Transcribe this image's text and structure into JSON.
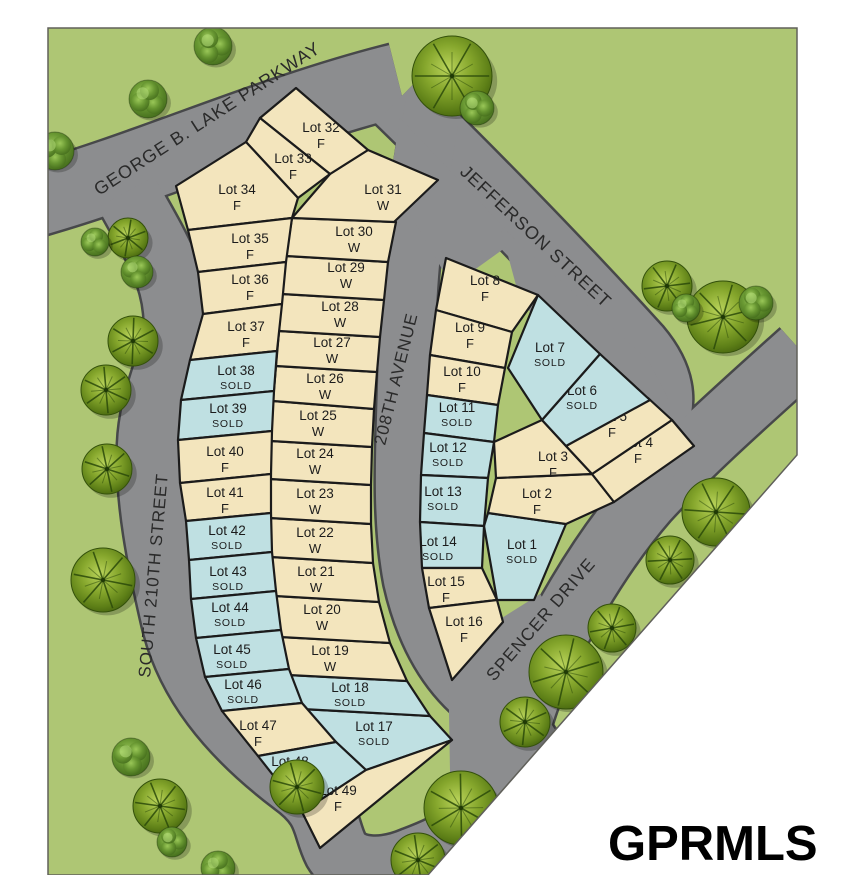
{
  "logo": {
    "text": "GPRMLS"
  },
  "colors": {
    "page": "#ffffff",
    "grass": "#aec674",
    "road": "#8c8d8f",
    "road_edge": "#47484a",
    "lot_available": "#f3e5bd",
    "lot_sold": "#bfe0e2",
    "lot_border": "#1b1b1b",
    "text": "#2a2a2a"
  },
  "map": {
    "outline": "48,28 797,28 797,455 428,875 48,875"
  },
  "streets": [
    {
      "name": "george-b-lake-parkway",
      "label": "GEORGE B. LAKE PARKWAY",
      "x": 99,
      "y": 196,
      "rotate": -33,
      "size": 18
    },
    {
      "name": "jefferson-street",
      "label": "JEFFERSON STREET",
      "x": 459,
      "y": 173,
      "rotate": 43,
      "size": 18
    },
    {
      "name": "208th-avenue",
      "label": "208TH AVENUE",
      "x": 385,
      "y": 446,
      "rotate": -76,
      "size": 17
    },
    {
      "name": "south-210th-street",
      "label": "SOUTH 210TH STREET",
      "x": 150,
      "y": 678,
      "rotate": -85,
      "size": 17
    },
    {
      "name": "spencer-drive",
      "label": "SPENCER DRIVE",
      "x": 494,
      "y": 682,
      "rotate": -49,
      "size": 17.5
    }
  ],
  "roads": [
    {
      "name": "george-b-lake-parkway",
      "d": "M 28,202 C 150,168 270,112 398,80",
      "w": 72
    },
    {
      "name": "jefferson-street",
      "d": "M 398,100 C 468,168 560,262 638,348 C 665,380 667,410 646,438",
      "w": 64
    },
    {
      "name": "spencer-drive",
      "d": "M 802,352 C 742,406 690,452 646,500 C 600,553 552,634 528,698 C 516,732 509,762 508,790",
      "w": 62
    },
    {
      "name": "south-210th-street",
      "d": "M 126,192 C 152,240 172,268 176,310 C 181,352 152,390 150,445 C 148,500 160,560 174,620 C 188,680 228,732 294,782 C 330,808 324,826 336,850 C 350,874 386,872 414,860 C 452,846 492,824 510,790",
      "w": 64
    },
    {
      "name": "208th-avenue",
      "d": "M 434,100 C 420,180 408,260 407,340 C 406,430 398,508 412,580 C 426,642 454,686 498,712 C 520,726 536,746 540,766",
      "w": 56
    },
    {
      "name": "junction-jefferson-avenue",
      "d": "M 400,118 L 516,240 L 452,286 L 390,180 Z",
      "fill": true
    },
    {
      "name": "junction-jefferson-flank",
      "d": "M 500,226 L 648,360 L 668,398 L 636,434 L 520,300 Z",
      "fill": true
    },
    {
      "name": "junction-spencer-elbow",
      "d": "M 628,392 L 700,436 L 656,504 L 602,450 Z",
      "fill": true
    },
    {
      "name": "junction-south",
      "d": "M 448,652 L 540,594 L 578,648 L 540,744 L 522,800 L 450,772 Z",
      "fill": true
    }
  ],
  "lots": [
    {
      "name": "Lot 1",
      "status": "SOLD",
      "pts": "488,513 566,524 534,600 497,600 484,526",
      "lx": 522,
      "ly": 549
    },
    {
      "name": "Lot 2",
      "status": "F",
      "pts": "496,478 592,474 614,502 566,524 488,513",
      "lx": 537,
      "ly": 498
    },
    {
      "name": "Lot 3",
      "status": "F",
      "pts": "494,442 542,420 566,446 592,474 496,478",
      "lx": 553,
      "ly": 461
    },
    {
      "name": "Lot 4",
      "status": "F",
      "pts": "672,420 694,446 614,502 592,474",
      "lx": 638,
      "ly": 447
    },
    {
      "name": "Lot 5",
      "status": "F",
      "pts": "648,398 672,420 592,474 566,446",
      "lx": 612,
      "ly": 421
    },
    {
      "name": "Lot 6",
      "status": "SOLD",
      "pts": "600,354 650,400 566,446 542,420",
      "lx": 582,
      "ly": 395
    },
    {
      "name": "Lot 7",
      "status": "SOLD",
      "pts": "538,295 600,354 542,420 508,368",
      "lx": 550,
      "ly": 352
    },
    {
      "name": "Lot 8",
      "status": "F",
      "pts": "446,258 538,295 512,332 436,310",
      "lx": 485,
      "ly": 285
    },
    {
      "name": "Lot 9",
      "status": "F",
      "pts": "436,310 512,332 505,368 430,355",
      "lx": 470,
      "ly": 332
    },
    {
      "name": "Lot 10",
      "status": "F",
      "pts": "430,355 505,368 498,405 427,395",
      "lx": 462,
      "ly": 376
    },
    {
      "name": "Lot 11",
      "status": "SOLD",
      "pts": "427,395 498,405 494,442 424,433",
      "lx": 457,
      "ly": 412
    },
    {
      "name": "Lot 12",
      "status": "SOLD",
      "pts": "424,433 494,442 488,478 421,475",
      "lx": 448,
      "ly": 452
    },
    {
      "name": "Lot 13",
      "status": "SOLD",
      "pts": "421,475 488,478 484,526 420,522",
      "lx": 443,
      "ly": 496
    },
    {
      "name": "Lot 14",
      "status": "SOLD",
      "pts": "420,522 484,526 482,568 422,568",
      "lx": 438,
      "ly": 546
    },
    {
      "name": "Lot 15",
      "status": "F",
      "pts": "422,568 482,568 497,600 429,608",
      "lx": 446,
      "ly": 586
    },
    {
      "name": "Lot 16",
      "status": "F",
      "pts": "429,608 497,600 503,622 452,680",
      "lx": 464,
      "ly": 626
    },
    {
      "name": "Lot 17",
      "status": "SOLD",
      "pts": "302,709 430,716 452,740 366,770 336,742",
      "lx": 374,
      "ly": 731
    },
    {
      "name": "Lot 18",
      "status": "SOLD",
      "pts": "288,675 407,681 430,716 302,709",
      "lx": 350,
      "ly": 692
    },
    {
      "name": "Lot 19",
      "status": "W",
      "pts": "280,637 390,643 407,681 288,675",
      "lx": 330,
      "ly": 655
    },
    {
      "name": "Lot 20",
      "status": "W",
      "pts": "275,596 379,602 390,643 280,637",
      "lx": 322,
      "ly": 614
    },
    {
      "name": "Lot 21",
      "status": "W",
      "pts": "271,557 373,563 379,602 275,596",
      "lx": 316,
      "ly": 576
    },
    {
      "name": "Lot 22",
      "status": "W",
      "pts": "270,518 371,524 373,563 271,557",
      "lx": 315,
      "ly": 537
    },
    {
      "name": "Lot 23",
      "status": "W",
      "pts": "270,479 371,485 371,524 270,518",
      "lx": 315,
      "ly": 498
    },
    {
      "name": "Lot 24",
      "status": "W",
      "pts": "271,441 372,447 371,485 270,479",
      "lx": 315,
      "ly": 458
    },
    {
      "name": "Lot 25",
      "status": "W",
      "pts": "273,401 374,409 372,447 271,441",
      "lx": 318,
      "ly": 420
    },
    {
      "name": "Lot 26",
      "status": "W",
      "pts": "276,366 377,372 374,409 273,401",
      "lx": 325,
      "ly": 383
    },
    {
      "name": "Lot 27",
      "status": "W",
      "pts": "279,331 380,337 377,372 276,366",
      "lx": 332,
      "ly": 347
    },
    {
      "name": "Lot 28",
      "status": "W",
      "pts": "282,294 384,300 380,337 279,331",
      "lx": 340,
      "ly": 311
    },
    {
      "name": "Lot 29",
      "status": "W",
      "pts": "286,256 388,262 384,300 282,294",
      "lx": 346,
      "ly": 272
    },
    {
      "name": "Lot 30",
      "status": "W",
      "pts": "292,218 396,222 388,262 286,256",
      "lx": 354,
      "ly": 236
    },
    {
      "name": "Lot 31",
      "status": "W",
      "pts": "368,150 438,180 394,222 292,218 330,174",
      "lx": 383,
      "ly": 194
    },
    {
      "name": "Lot 32",
      "status": "F",
      "pts": "296,88 368,150 330,174 260,118",
      "lx": 321,
      "ly": 132
    },
    {
      "name": "Lot 33",
      "status": "F",
      "pts": "260,118 330,174 298,198 246,142",
      "lx": 293,
      "ly": 163
    },
    {
      "name": "Lot 34",
      "status": "F",
      "pts": "246,142 298,198 292,218 188,230 176,186",
      "lx": 237,
      "ly": 194
    },
    {
      "name": "Lot 35",
      "status": "F",
      "pts": "188,230 292,218 286,262 198,272",
      "lx": 250,
      "ly": 243
    },
    {
      "name": "Lot 36",
      "status": "F",
      "pts": "198,272 286,262 282,304 203,314",
      "lx": 250,
      "ly": 284
    },
    {
      "name": "Lot 37",
      "status": "F",
      "pts": "203,314 282,304 277,351 190,360",
      "lx": 246,
      "ly": 331
    },
    {
      "name": "Lot 38",
      "status": "SOLD",
      "pts": "190,360 277,351 274,391 181,400",
      "lx": 236,
      "ly": 375
    },
    {
      "name": "Lot 39",
      "status": "SOLD",
      "pts": "181,400 274,391 272,431 178,440",
      "lx": 228,
      "ly": 413
    },
    {
      "name": "Lot 40",
      "status": "F",
      "pts": "178,440 272,431 271,474 180,483",
      "lx": 225,
      "ly": 456
    },
    {
      "name": "Lot 41",
      "status": "F",
      "pts": "180,483 271,474 271,513 186,521",
      "lx": 225,
      "ly": 497
    },
    {
      "name": "Lot 42",
      "status": "SOLD",
      "pts": "186,521 271,513 272,552 189,560",
      "lx": 227,
      "ly": 535
    },
    {
      "name": "Lot 43",
      "status": "SOLD",
      "pts": "189,560 272,552 276,591 191,599",
      "lx": 228,
      "ly": 576
    },
    {
      "name": "Lot 44",
      "status": "SOLD",
      "pts": "191,599 276,591 281,630 196,638",
      "lx": 230,
      "ly": 612
    },
    {
      "name": "Lot 45",
      "status": "SOLD",
      "pts": "196,638 281,630 289,669 205,677",
      "lx": 232,
      "ly": 654
    },
    {
      "name": "Lot 46",
      "status": "SOLD",
      "pts": "205,677 289,669 302,703 222,711",
      "lx": 243,
      "ly": 689
    },
    {
      "name": "Lot 47",
      "status": "F",
      "pts": "222,711 302,703 336,742 258,756",
      "lx": 258,
      "ly": 730
    },
    {
      "name": "Lot 48",
      "status": "SOLD",
      "pts": "258,756 336,742 366,770 302,812",
      "lx": 290,
      "ly": 766
    },
    {
      "name": "Lot 49",
      "status": "F",
      "pts": "302,812 366,770 452,740 320,848",
      "lx": 338,
      "ly": 795
    }
  ],
  "trees": {
    "detailed": [
      [
        452,
        76,
        40
      ],
      [
        667,
        286,
        25
      ],
      [
        723,
        317,
        36
      ],
      [
        128,
        238,
        20
      ],
      [
        133,
        341,
        25
      ],
      [
        106,
        390,
        25
      ],
      [
        107,
        469,
        25
      ],
      [
        103,
        580,
        32
      ],
      [
        716,
        512,
        34
      ],
      [
        670,
        560,
        24
      ],
      [
        612,
        628,
        24
      ],
      [
        566,
        672,
        37
      ],
      [
        525,
        722,
        25
      ],
      [
        461,
        808,
        37
      ],
      [
        418,
        860,
        27
      ],
      [
        297,
        787,
        27
      ],
      [
        160,
        806,
        27
      ]
    ],
    "bushes": [
      [
        213,
        46,
        19
      ],
      [
        148,
        99,
        19
      ],
      [
        55,
        151,
        19
      ],
      [
        477,
        108,
        17
      ],
      [
        95,
        242,
        14
      ],
      [
        137,
        272,
        16
      ],
      [
        756,
        303,
        17
      ],
      [
        686,
        308,
        14
      ],
      [
        131,
        757,
        19
      ],
      [
        172,
        842,
        15
      ],
      [
        218,
        868,
        17
      ]
    ]
  }
}
